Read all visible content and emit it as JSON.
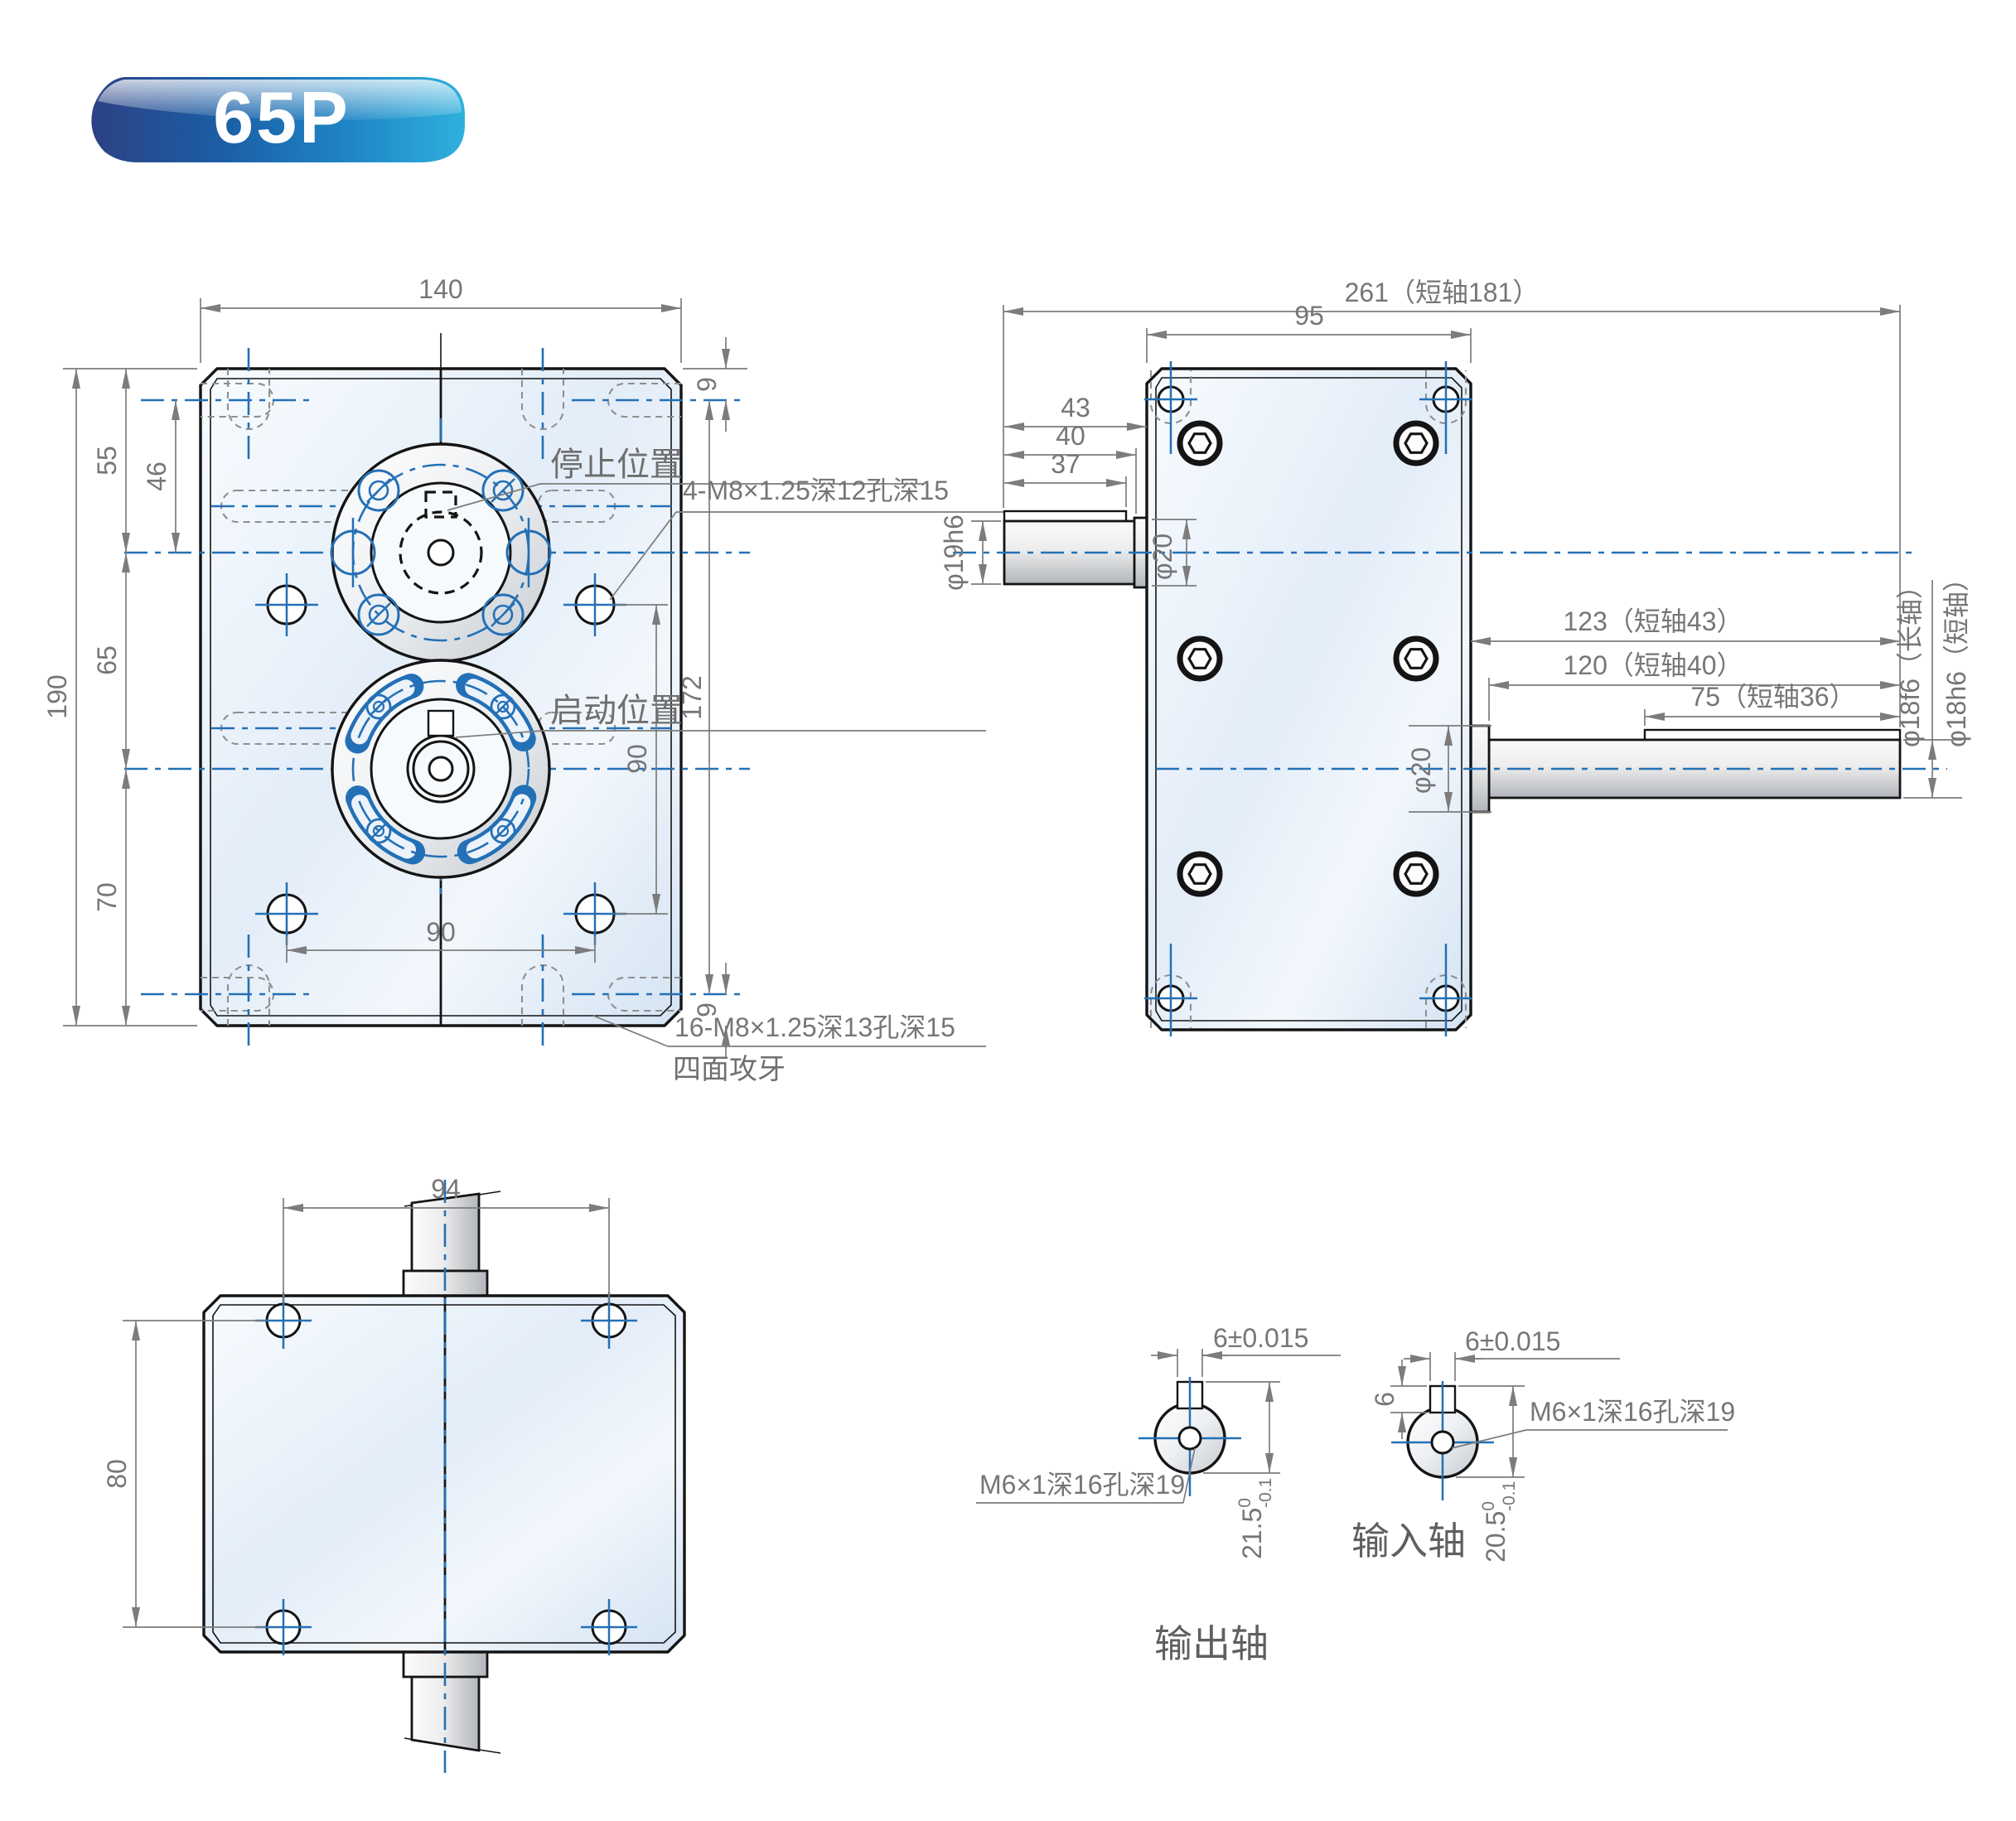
{
  "badge": {
    "label": "65P"
  },
  "colors": {
    "centerline_blue": "#2470b6",
    "dimension_gray": "#7c7c7c",
    "outline_black": "#141414",
    "body_fill_light": "#f6fafe",
    "body_fill_dark": "#d6e4f3",
    "badge_dark_blue": "#2c4184",
    "badge_cyan": "#2fb0dd"
  },
  "front_view": {
    "dim_width": "140",
    "dim_height": "190",
    "dim_top": "55",
    "dim_top_inner": "46",
    "dim_mid": "65",
    "dim_bottom": "70",
    "dim_edge_top": "9",
    "dim_edge_bottom": "9",
    "dim_right_span": "172",
    "dim_hole_vspan": "90",
    "dim_hole_hspan": "90",
    "label_stop": "停止位置",
    "label_start": "启动位置",
    "label_tap_front": "4-M8×1.25深12孔深15",
    "label_tap_side": "16-M8×1.25深13孔深15",
    "label_tap_note": "四面攻牙"
  },
  "side_view": {
    "dim_total": "261（短轴181）",
    "dim_body": "95",
    "dim_in1": "43",
    "dim_in2": "40",
    "dim_in3": "37",
    "label_in_dia": "φ19h6",
    "label_in_hub": "φ20",
    "dim_out1": "123（短轴43）",
    "dim_out2": "120（短轴40）",
    "dim_out3": "75（短轴36）",
    "label_out_hub": "φ20",
    "label_out_dia_long": "φ18f6（长轴）",
    "label_out_dia_short": "φ18h6（短轴）"
  },
  "top_view": {
    "dim_width": "94",
    "dim_height": "80"
  },
  "detail_output": {
    "caption": "输出轴",
    "dim_key": "6±0.015",
    "label_thread": "M6×1深16孔深19",
    "dim_height": "21.5",
    "tol_upper": "0",
    "tol_lower": "-0.1"
  },
  "detail_input": {
    "caption": "输入轴",
    "dim_key": "6±0.015",
    "dim_key_depth": "6",
    "label_thread": "M6×1深16孔深19",
    "dim_height": "20.5",
    "tol_upper": "0",
    "tol_lower": "-0.1"
  }
}
